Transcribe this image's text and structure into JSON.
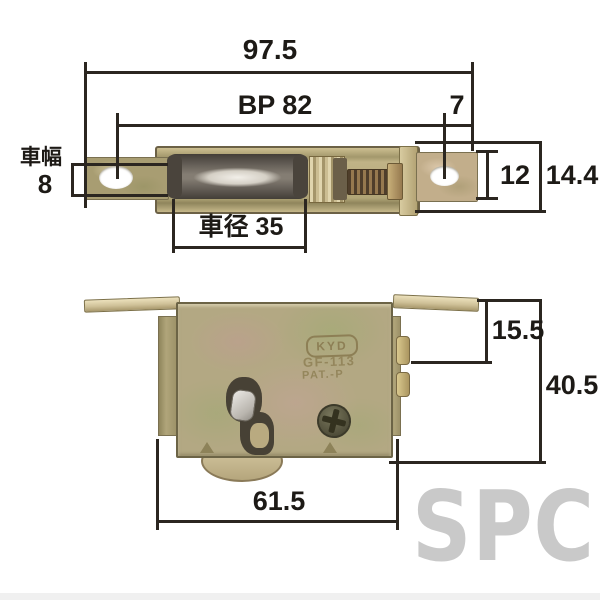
{
  "watermark": "SPC",
  "top_view": {
    "dims": {
      "total_width": "97.5",
      "bolt_pitch": "BP 82",
      "edge_offset": "7",
      "wheel_width_label": "車幅",
      "wheel_width_value": "8",
      "wheel_diameter": "車径 35",
      "plate_width": "12",
      "total_height": "14.4"
    }
  },
  "bottom_view": {
    "dims": {
      "top_to_screw": "15.5",
      "total_height": "40.5",
      "body_width": "61.5"
    },
    "stamp": {
      "logo": "KYD",
      "model": "GF-113",
      "patent": "PAT.-P"
    }
  },
  "colors": {
    "dimension_line": "#2b2620",
    "plating_olive": "#a89d72",
    "plating_mottled": "#b3a883",
    "wheel_dark": "#4a443c",
    "watermark_gray": "#c9c9c9"
  }
}
